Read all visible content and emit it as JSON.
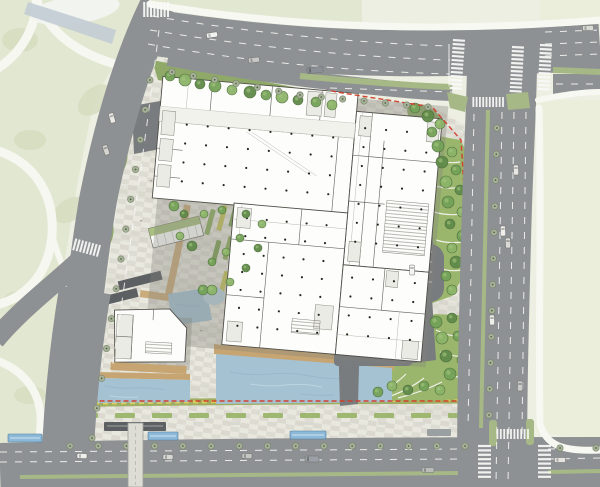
{
  "scene": {
    "kind": "architectural site plan",
    "visible_text": []
  },
  "colors": {
    "background": "#edefe2",
    "park": "#e2e7d1",
    "park_patch": "#d6ddc0",
    "verge": "#eaeedb",
    "road": "#8e9193",
    "road_dark": "#797c7e",
    "paving_light": "#e9e8df",
    "paving_dark": "#d8d7cc",
    "building": "#fdfdfb",
    "building_outline": "#504f49",
    "water": "#a5c2d3",
    "water_wave": "#8fb2c6",
    "deck": "#c6a572",
    "median_green": "#a6b885",
    "site_green": "#8fa968",
    "lawn": "#9ab56c",
    "street_tree": "#a7b29a",
    "street_tree_edge": "#788468",
    "boundary_red": "#d23b28",
    "flower_yellow": "#d9cf5a",
    "flower_green": "#9fae62",
    "shelter_blue": "#8db9d8",
    "canopy_dark": "#5c6063",
    "crosswalk": "#fafaf8",
    "tree_palette": [
      "#5f8a4a",
      "#74a258",
      "#8cb469",
      "#a5c47e"
    ],
    "column_dot": "#262620"
  },
  "street_tree_rows": [
    [
      172,
      72,
      300,
      95,
      7
    ],
    [
      300,
      95,
      428,
      107,
      7
    ],
    [
      497,
      128,
      489,
      415,
      12
    ],
    [
      70,
      446,
      465,
      446,
      15
    ],
    [
      560,
      448,
      596,
      448,
      2
    ],
    [
      150,
      80,
      92,
      438,
      13
    ]
  ],
  "site_trees": [
    [
      170,
      76,
      5,
      1
    ],
    [
      185,
      80,
      6,
      2
    ],
    [
      200,
      84,
      5,
      0
    ],
    [
      215,
      86,
      6,
      1
    ],
    [
      232,
      90,
      5,
      2
    ],
    [
      250,
      92,
      6,
      0
    ],
    [
      266,
      95,
      5,
      1
    ],
    [
      282,
      97,
      6,
      2
    ],
    [
      298,
      100,
      5,
      0
    ],
    [
      316,
      102,
      5,
      1
    ],
    [
      332,
      105,
      5,
      2
    ],
    [
      415,
      108,
      5,
      1
    ],
    [
      428,
      116,
      6,
      0
    ],
    [
      440,
      124,
      5,
      2
    ],
    [
      432,
      132,
      5,
      1
    ],
    [
      438,
      146,
      6,
      1
    ],
    [
      452,
      152,
      5,
      2
    ],
    [
      442,
      162,
      6,
      0
    ],
    [
      456,
      170,
      5,
      1
    ],
    [
      446,
      182,
      6,
      2
    ],
    [
      460,
      190,
      5,
      0
    ],
    [
      448,
      202,
      6,
      1
    ],
    [
      462,
      212,
      5,
      2
    ],
    [
      450,
      224,
      5,
      0
    ],
    [
      463,
      236,
      6,
      1
    ],
    [
      452,
      248,
      5,
      2
    ],
    [
      456,
      262,
      6,
      0
    ],
    [
      446,
      276,
      5,
      1
    ],
    [
      452,
      290,
      5,
      2
    ],
    [
      436,
      322,
      6,
      1
    ],
    [
      452,
      318,
      5,
      0
    ],
    [
      468,
      322,
      5,
      2
    ],
    [
      442,
      338,
      6,
      2
    ],
    [
      458,
      336,
      5,
      1
    ],
    [
      470,
      344,
      5,
      0
    ],
    [
      446,
      356,
      6,
      0
    ],
    [
      462,
      360,
      5,
      2
    ],
    [
      450,
      374,
      6,
      1
    ],
    [
      466,
      378,
      5,
      0
    ],
    [
      440,
      390,
      5,
      2
    ],
    [
      424,
      386,
      5,
      1
    ],
    [
      408,
      390,
      5,
      0
    ],
    [
      392,
      386,
      5,
      2
    ],
    [
      378,
      392,
      5,
      1
    ],
    [
      204,
      214,
      4,
      2
    ],
    [
      222,
      210,
      4,
      1
    ],
    [
      246,
      214,
      4,
      0
    ],
    [
      262,
      224,
      4,
      2
    ],
    [
      240,
      238,
      4,
      1
    ],
    [
      258,
      248,
      4,
      0
    ],
    [
      226,
      252,
      4,
      2
    ],
    [
      212,
      262,
      4,
      1
    ],
    [
      246,
      268,
      4,
      0
    ],
    [
      230,
      282,
      4,
      2
    ],
    [
      120,
      150,
      5,
      1
    ],
    [
      114,
      170,
      5,
      2
    ],
    [
      108,
      192,
      5,
      0
    ],
    [
      104,
      214,
      4,
      1
    ],
    [
      100,
      238,
      5,
      2
    ],
    [
      96,
      260,
      4,
      0
    ],
    [
      92,
      282,
      5,
      1
    ],
    [
      88,
      304,
      4,
      2
    ],
    [
      203,
      290,
      5,
      1
    ],
    [
      98,
      312,
      5,
      0
    ],
    [
      94,
      332,
      4,
      2
    ],
    [
      192,
      246,
      5,
      0
    ],
    [
      180,
      236,
      4,
      2
    ],
    [
      174,
      206,
      5,
      1
    ],
    [
      184,
      214,
      4,
      0
    ],
    [
      212,
      290,
      5,
      2
    ]
  ],
  "planters": [
    [
      210,
      222,
      26,
      5,
      -75,
      0
    ],
    [
      222,
      218,
      26,
      5,
      -75,
      1
    ],
    [
      234,
      214,
      26,
      5,
      -75,
      2
    ],
    [
      250,
      212,
      20,
      4,
      -75,
      1
    ],
    [
      262,
      208,
      20,
      4,
      -75,
      0
    ],
    [
      216,
      252,
      24,
      5,
      -75,
      2
    ],
    [
      228,
      248,
      24,
      5,
      -75,
      0
    ],
    [
      244,
      244,
      22,
      4,
      -75,
      1
    ],
    [
      258,
      240,
      22,
      4,
      -75,
      2
    ],
    [
      224,
      282,
      22,
      5,
      -75,
      1
    ],
    [
      238,
      278,
      22,
      4,
      -75,
      0
    ],
    [
      252,
      274,
      20,
      4,
      -75,
      2
    ],
    [
      266,
      270,
      20,
      4,
      -75,
      1
    ],
    [
      280,
      244,
      18,
      4,
      -75,
      0
    ],
    [
      276,
      216,
      18,
      4,
      -75,
      2
    ]
  ],
  "planter_palette": [
    "#8fae62",
    "#c3c45c",
    "#7fa257"
  ],
  "tan_paths": [
    [
      178,
      250,
      92,
      7,
      -78
    ],
    [
      158,
      296,
      36,
      7,
      8
    ]
  ],
  "cars": [
    [
      212,
      35,
      11,
      5,
      -8,
      "#f2f2f0"
    ],
    [
      254,
      60,
      11,
      5,
      -7,
      "#c8c9c6"
    ],
    [
      315,
      70,
      16,
      6,
      -6,
      "#8b9097"
    ],
    [
      588,
      28,
      11,
      5,
      -2,
      "#d8d8d4"
    ],
    [
      112,
      118,
      10,
      5,
      74,
      "#eceae6"
    ],
    [
      106,
      150,
      10,
      5,
      72,
      "#d6d5d0"
    ],
    [
      503,
      231,
      10,
      5,
      88,
      "#f0efec"
    ],
    [
      508,
      243,
      10,
      5,
      88,
      "#dadad6"
    ],
    [
      492,
      320,
      10,
      5,
      88,
      "#eceeea"
    ],
    [
      520,
      386,
      10,
      5,
      90,
      "#c9cbc8"
    ],
    [
      516,
      170,
      10,
      5,
      88,
      "#e8e8e4"
    ],
    [
      82,
      456,
      10,
      5,
      2,
      "#efefec"
    ],
    [
      168,
      457,
      10,
      5,
      1,
      "#d8d9d5"
    ],
    [
      247,
      456,
      10,
      5,
      1,
      "#c4c6c3"
    ],
    [
      312,
      459,
      14,
      6,
      0,
      "#9aa0a5"
    ],
    [
      428,
      470,
      12,
      5,
      0,
      "#b9bcb9"
    ],
    [
      560,
      460,
      11,
      5,
      0,
      "#e4e4e0"
    ],
    [
      412,
      270,
      10,
      5,
      88,
      "#f4f4f1"
    ]
  ],
  "crosswalks": [
    [
      168,
      2,
      90,
      8,
      3.4,
      15,
      2
    ],
    [
      453,
      40,
      4,
      13,
      4,
      12,
      2.2
    ],
    [
      512,
      47,
      3,
      12,
      4,
      12,
      2.2
    ],
    [
      540,
      45,
      3,
      12,
      4,
      12,
      2.2
    ],
    [
      503,
      97,
      90,
      10,
      3.3,
      10,
      1.8
    ],
    [
      100,
      245,
      105,
      8,
      3.5,
      12,
      2
    ],
    [
      478,
      446,
      0,
      8,
      4.4,
      13,
      2.2
    ],
    [
      538,
      446,
      0,
      8,
      4.4,
      13,
      2.2
    ],
    [
      528,
      429,
      90,
      10,
      3.4,
      10,
      1.8
    ]
  ],
  "column_grids": [
    [
      178,
      134,
      8,
      4,
      21,
      19
    ],
    [
      356,
      122,
      4,
      7,
      21,
      19
    ],
    [
      246,
      222,
      5,
      7,
      20,
      18
    ],
    [
      356,
      272,
      4,
      4,
      21,
      19
    ]
  ],
  "plaza_marks": [
    [
      150,
      180
    ],
    [
      200,
      170
    ],
    [
      240,
      190
    ],
    [
      310,
      180
    ],
    [
      140,
      220
    ],
    [
      330,
      150
    ],
    [
      370,
      140
    ],
    [
      420,
      130
    ],
    [
      165,
      310
    ],
    [
      200,
      330
    ],
    [
      225,
      335
    ],
    [
      300,
      395
    ],
    [
      330,
      398
    ],
    [
      360,
      396
    ],
    [
      390,
      394
    ],
    [
      270,
      120
    ],
    [
      230,
      110
    ],
    [
      190,
      120
    ],
    [
      430,
      220
    ],
    [
      436,
      230
    ],
    [
      360,
      200
    ],
    [
      390,
      180
    ]
  ],
  "bus_shelters": [
    [
      8,
      434,
      34,
      8
    ],
    [
      148,
      432,
      30,
      8
    ],
    [
      290,
      431,
      36,
      8
    ]
  ],
  "bottom_planter_xs": [
    78,
    115,
    152,
    189,
    226,
    263,
    300,
    337,
    374,
    411,
    448
  ]
}
